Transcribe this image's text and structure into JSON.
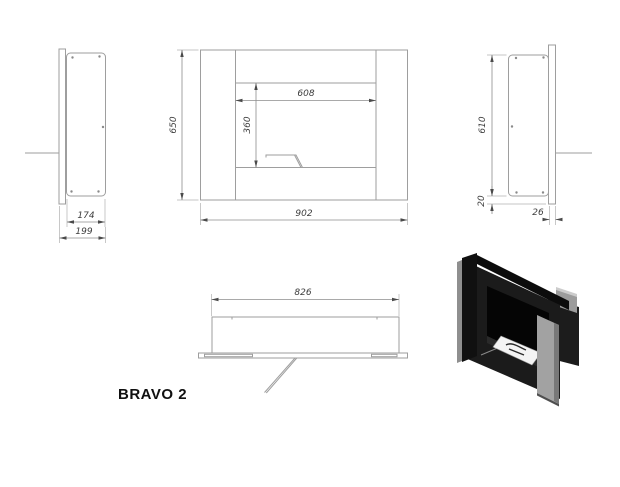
{
  "title": "BRAVO 2",
  "drawing_colors": {
    "line": "#9e9e9e",
    "dimension_text": "#3d3d3d",
    "render_body": "#141414",
    "render_column": "#a2a2a2",
    "render_tray": "#f4f4f4"
  },
  "dims": {
    "left_inner": "174",
    "left_total": "199",
    "front_height": "650",
    "front_width": "902",
    "front_opening_width": "608",
    "front_opening_height": "360",
    "right_height": "610",
    "right_bottom_gap": "20",
    "right_plate_depth": "26",
    "top_body_width": "826"
  }
}
